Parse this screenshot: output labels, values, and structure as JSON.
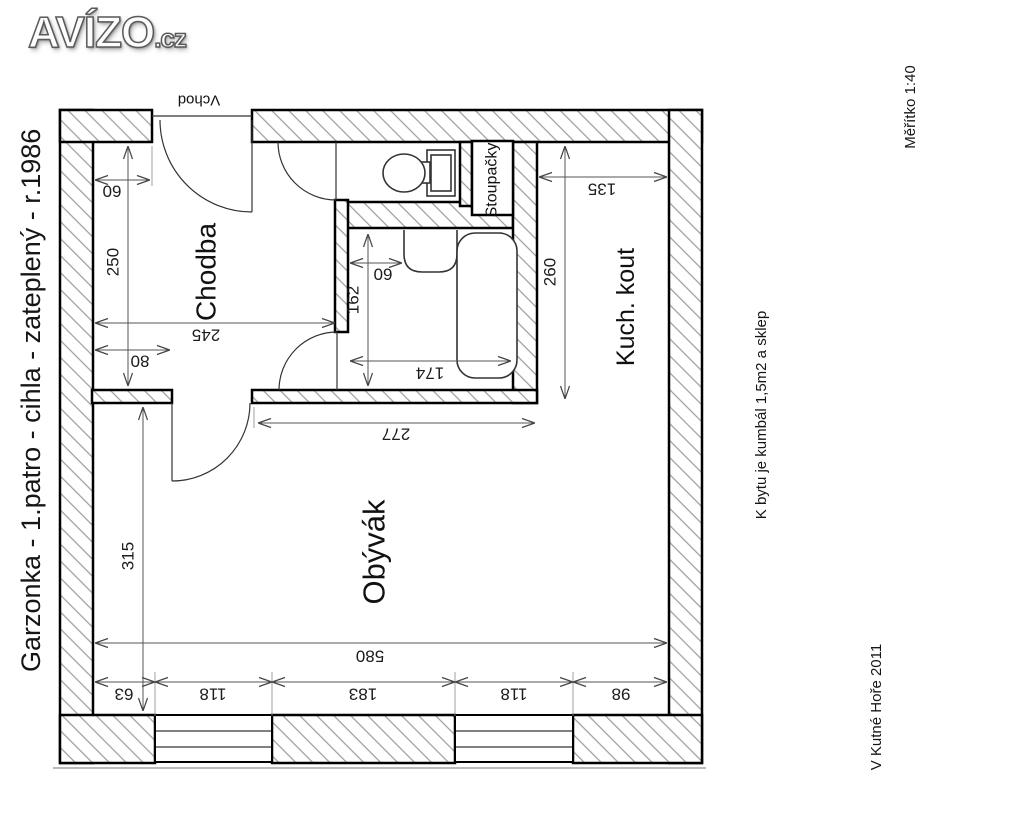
{
  "logo": {
    "brand": "AVÍZO",
    "tld": ".cz"
  },
  "annotations": {
    "left_title": "Garzonka - 1.patro - cihla - zateplený - r.1986",
    "scale": "Měřítko  1:40",
    "note": "K bytu je kumbál 1,5m2  a sklep",
    "place_year": "V Kutné Hoře  2011"
  },
  "plan": {
    "entrance": "Vchod",
    "rooms": {
      "hall": "Chodba",
      "risers": "Stoupačky",
      "kitchen": "Kuch. kout",
      "living": "Obývák"
    },
    "dimensions": {
      "hall_entry_offset": "60",
      "hall_depth": "250",
      "hall_width": "245",
      "hall_door_width": "80",
      "bath_basin_offset": "60",
      "bath_depth": "162",
      "bath_width": "174",
      "kitchen_width": "135",
      "kitchen_depth": "260",
      "living_top_width": "277",
      "living_depth": "315",
      "living_width": "580",
      "bottom_chain": [
        "63",
        "118",
        "183",
        "118",
        "98"
      ]
    }
  }
}
